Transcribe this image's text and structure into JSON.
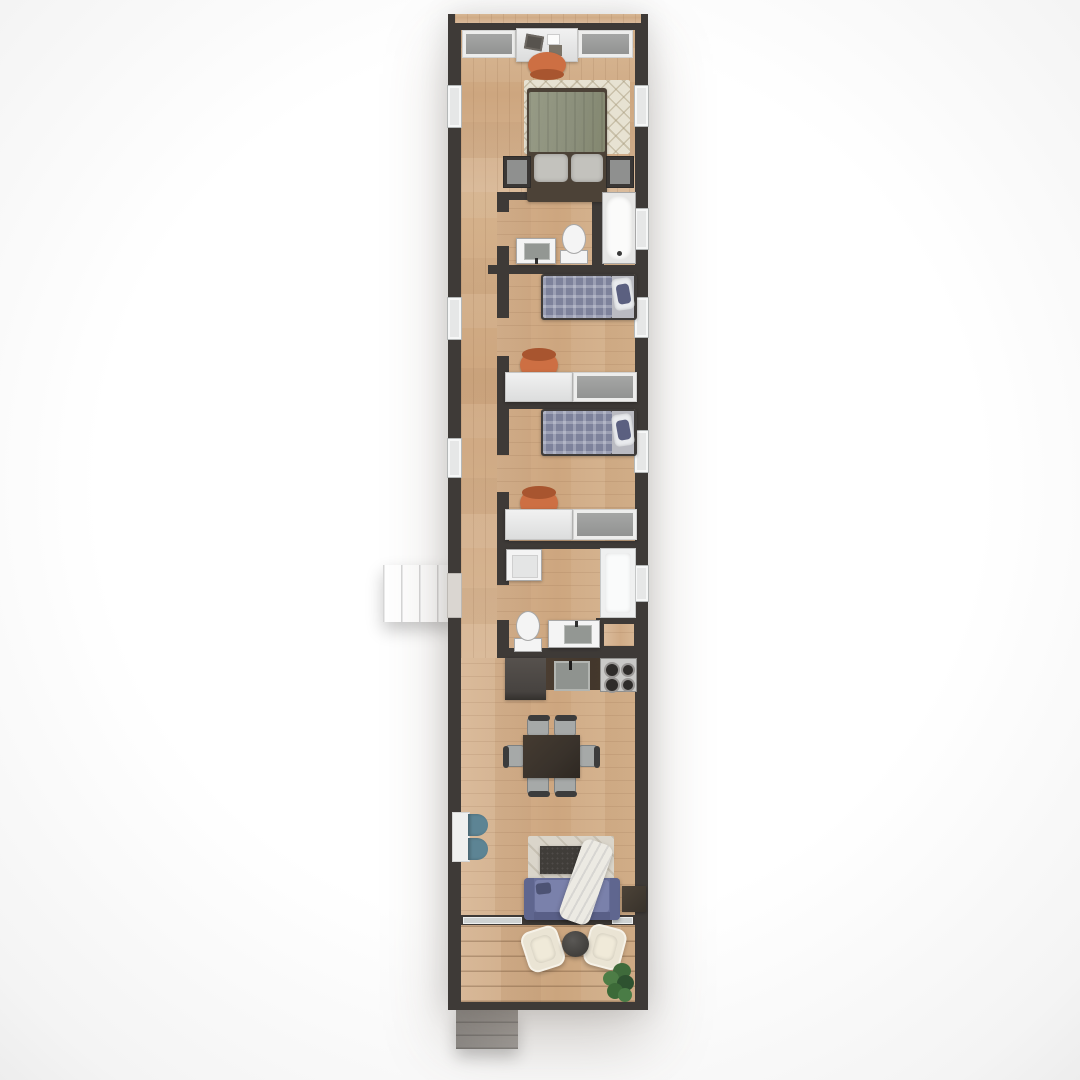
{
  "meta": {
    "title": "Top-down 3D floor plan of a long narrow apartment",
    "view": "overhead render, no visible text"
  },
  "palette": {
    "wall": "#3e3a37",
    "floor_a": "#d8b795",
    "floor_b": "#cda67f",
    "window": "#e6e7e7",
    "window_frame": "#b5b8b8",
    "wardrobe": "#929392",
    "unit_white": "#dcdddd",
    "chair_orange": "#cd6f43",
    "chair_orange_dark": "#a8552f",
    "rug_cream": "#e7e2d2",
    "bed_green": "#8b8f7b",
    "bed_frame": "#4c4237",
    "pillow": "#c3c2bd",
    "plaid": "#7d829b",
    "sheet": "#babbc2",
    "fixture": "#f4f4f4",
    "fixture_border": "#a8a8a8",
    "basin": "#939793",
    "sofa": "#7a81ab",
    "sofa_dark": "#676e99",
    "rug_living": "#dad5ca",
    "table_dark": "#39322b",
    "cushion": "#a6a9a8",
    "teal": "#5d8494",
    "counter": "#43372c",
    "appliance": "#56514d",
    "stove": "#c9c9c7",
    "burner": "#2e2c2a",
    "armchair": "#eae4d4",
    "plant": "#3f6b3b",
    "plant_dark": "#2e5230",
    "steps": "#9d9a97",
    "blanket": "#eceae3"
  },
  "floorplan": {
    "rooms": [
      {
        "name": "master bedroom",
        "furniture": [
          "built-in wardrobe left",
          "desk with laptop",
          "orange desk chair",
          "patterned rug",
          "double bed with sage duvet",
          "nightstand left",
          "nightstand right",
          "built-in wardrobe right"
        ]
      },
      {
        "name": "bathroom",
        "furniture": [
          "bathtub",
          "toilet",
          "washbasin vanity"
        ]
      },
      {
        "name": "kids bedroom 1",
        "furniture": [
          "single bed with plaid duvet",
          "desk",
          "orange desk chair",
          "wardrobe"
        ]
      },
      {
        "name": "kids bedroom 2",
        "furniture": [
          "single bed with plaid duvet",
          "desk",
          "orange desk chair",
          "wardrobe"
        ]
      },
      {
        "name": "bathroom laundry",
        "furniture": [
          "washing machine",
          "toilet",
          "washbasin vanity",
          "shower enclosure"
        ]
      },
      {
        "name": "kitchen",
        "furniture": [
          "refrigerator",
          "dark counter with sink",
          "gas hob 4 burners"
        ]
      },
      {
        "name": "living dining area",
        "furniture": [
          "dining table",
          "6 dining chairs",
          "console desk",
          "2 teal stools",
          "area rug",
          "coffee table",
          "blue sofa",
          "throw blanket",
          "side table"
        ]
      },
      {
        "name": "terrace",
        "furniture": [
          "armchair",
          "armchair",
          "round side table",
          "potted plant"
        ]
      },
      {
        "name": "hallway",
        "furniture": []
      }
    ],
    "exterior": [
      "entry porch with steps on left side",
      "entry steps at bottom left"
    ],
    "windows": {
      "left_wall": 3,
      "right_wall": 5
    },
    "doors": {
      "exterior": 2
    }
  }
}
